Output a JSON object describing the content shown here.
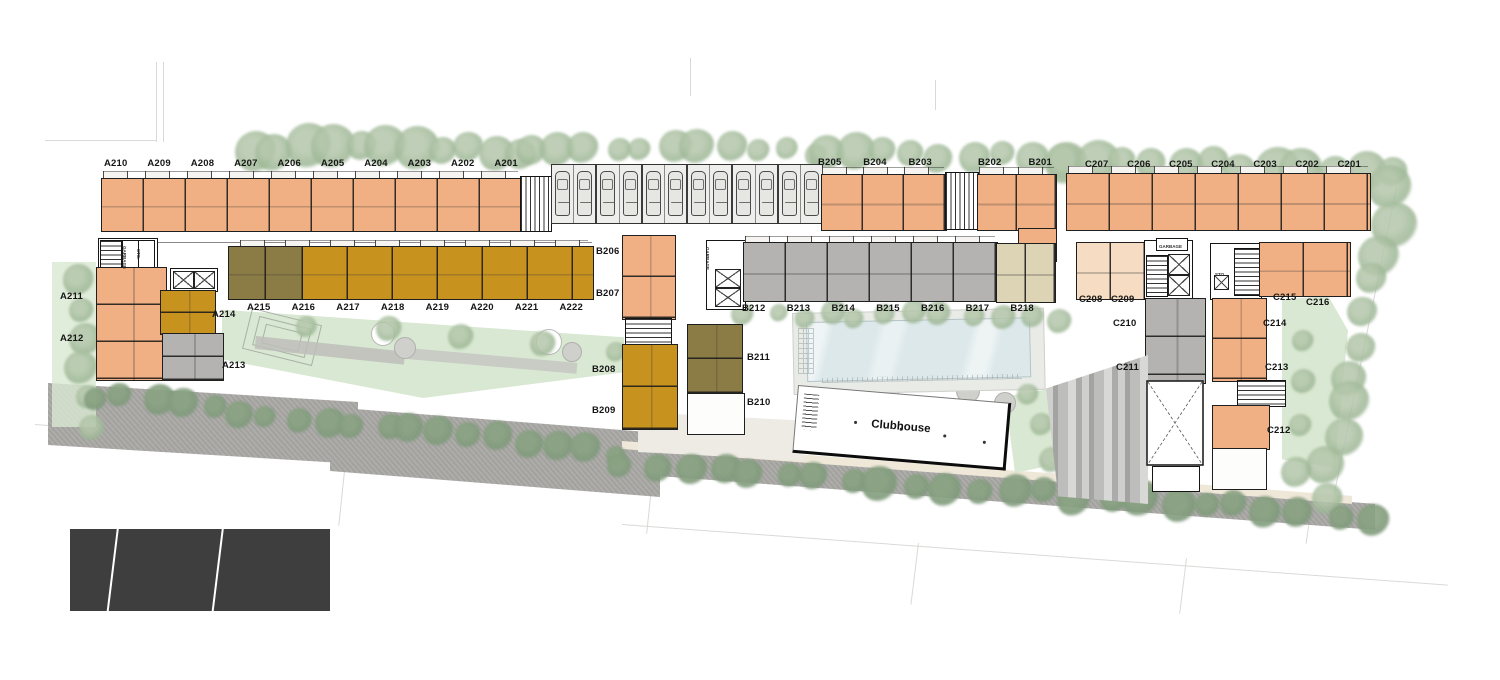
{
  "colors": {
    "wall": "#1f1f1f",
    "unit-orange": "#f1b083",
    "unit-peach": "#f6dcc2",
    "unit-gold": "#c8921f",
    "unit-olive": "#8b7b45",
    "unit-gray": "#b4b3b1",
    "unit-beige": "#ddd4b6",
    "pool": "#dce8ea",
    "lawn": "#d9e8d2",
    "road": "#a9a8a5",
    "path": "#efe8d9",
    "tree": "#9cb694",
    "tree-light": "#b4c7ab",
    "tree-dark": "#7e997a",
    "tree-dark-light": "#8aa382",
    "dark-block": "#3e3e3e"
  },
  "unit_rows": {
    "a_top": [
      "A210",
      "A209",
      "A208",
      "A207",
      "A206",
      "A205",
      "A204",
      "A203",
      "A202",
      "A201"
    ],
    "b_top_left": [
      "B205",
      "B204",
      "B203"
    ],
    "b_top_right": [
      "B202",
      "B201"
    ],
    "c_top": [
      "C207",
      "C206",
      "C205",
      "C204",
      "C203",
      "C202",
      "C201"
    ],
    "a_mid": [
      "A215",
      "A216",
      "A217",
      "A218",
      "A219",
      "A220",
      "A221",
      "A222"
    ],
    "b_mid": [
      "B212",
      "B213",
      "B214",
      "B215",
      "B216",
      "B217",
      "B218"
    ]
  },
  "unit_labels": [
    {
      "text": "A211",
      "x": 60,
      "y": 291
    },
    {
      "text": "A212",
      "x": 60,
      "y": 333
    },
    {
      "text": "A214",
      "x": 212,
      "y": 309
    },
    {
      "text": "A213",
      "x": 222,
      "y": 360
    },
    {
      "text": "B206",
      "x": 596,
      "y": 246
    },
    {
      "text": "B207",
      "x": 596,
      "y": 288
    },
    {
      "text": "B208",
      "x": 592,
      "y": 364
    },
    {
      "text": "B209",
      "x": 592,
      "y": 405
    },
    {
      "text": "B211",
      "x": 747,
      "y": 352
    },
    {
      "text": "B210",
      "x": 747,
      "y": 397
    },
    {
      "text": "C208",
      "x": 1079,
      "y": 294
    },
    {
      "text": "C209",
      "x": 1111,
      "y": 294
    },
    {
      "text": "C210",
      "x": 1113,
      "y": 318
    },
    {
      "text": "C211",
      "x": 1116,
      "y": 362
    },
    {
      "text": "C215",
      "x": 1273,
      "y": 292
    },
    {
      "text": "C216",
      "x": 1306,
      "y": 297
    },
    {
      "text": "C214",
      "x": 1263,
      "y": 318
    },
    {
      "text": "C213",
      "x": 1265,
      "y": 362
    },
    {
      "text": "C212",
      "x": 1267,
      "y": 425
    }
  ],
  "tiny_labels": [
    {
      "text": "GARBAGE",
      "x": 127,
      "y": 246,
      "rot": 90
    },
    {
      "text": "STO.",
      "x": 141,
      "y": 249,
      "rot": 90
    },
    {
      "text": "GARBAGE",
      "x": 710,
      "y": 247,
      "rot": 90
    },
    {
      "text": "GARBAGE",
      "x": 1159,
      "y": 244,
      "rot": 0
    },
    {
      "text": "STO.",
      "x": 1215,
      "y": 272,
      "rot": 0
    }
  ],
  "clubhouse": {
    "label": "Clubhouse"
  },
  "parking": {
    "stall_count": 12
  }
}
